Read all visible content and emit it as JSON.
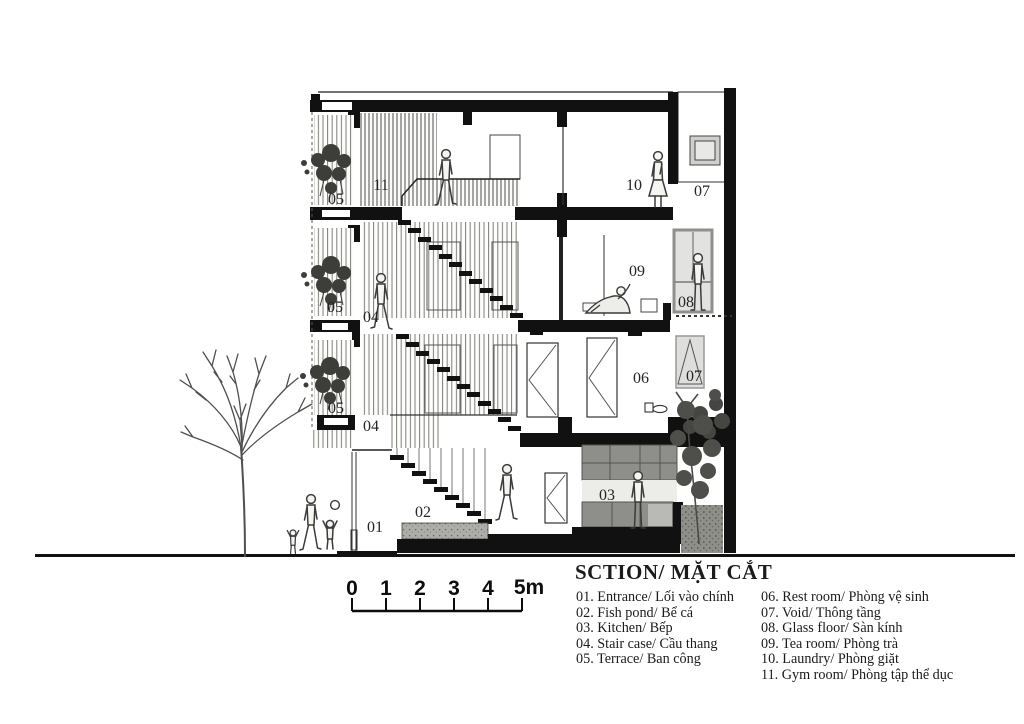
{
  "title": "SCTION/ MẶT CẮT",
  "scalebar": {
    "labels": [
      "0",
      "1",
      "2",
      "3",
      "4",
      "5m"
    ]
  },
  "rooms": {
    "entrance": "01",
    "fish_pond": "02",
    "kitchen": "03",
    "stair_f3": "04",
    "stair_f2": "04",
    "terrace_f4": "05",
    "terrace_f3": "05",
    "terrace_f2": "05",
    "rest_room": "06",
    "void_top": "07",
    "void_f2": "07",
    "glass_floor": "08",
    "tea_room": "09",
    "laundry": "10",
    "gym": "11"
  },
  "legend": {
    "column1": [
      "01. Entrance/ Lối vào chính",
      "02. Fish pond/ Bể cá",
      "03. Kitchen/ Bếp",
      "04. Stair case/ Cầu thang",
      "05. Terrace/ Ban công"
    ],
    "column2": [
      "06. Rest room/ Phòng vệ sinh",
      "07. Void/ Thông tầng",
      "08. Glass floor/ Sàn kính",
      "09. Tea room/ Phòng trà",
      "10. Laundry/ Phòng giặt",
      "11. Gym room/ Phòng tập thể dục"
    ]
  },
  "colors": {
    "ink": "#141414",
    "cabinet": "#8e8e8b",
    "glass": "#e2e2e0",
    "gravel": "#aaaaa7"
  }
}
